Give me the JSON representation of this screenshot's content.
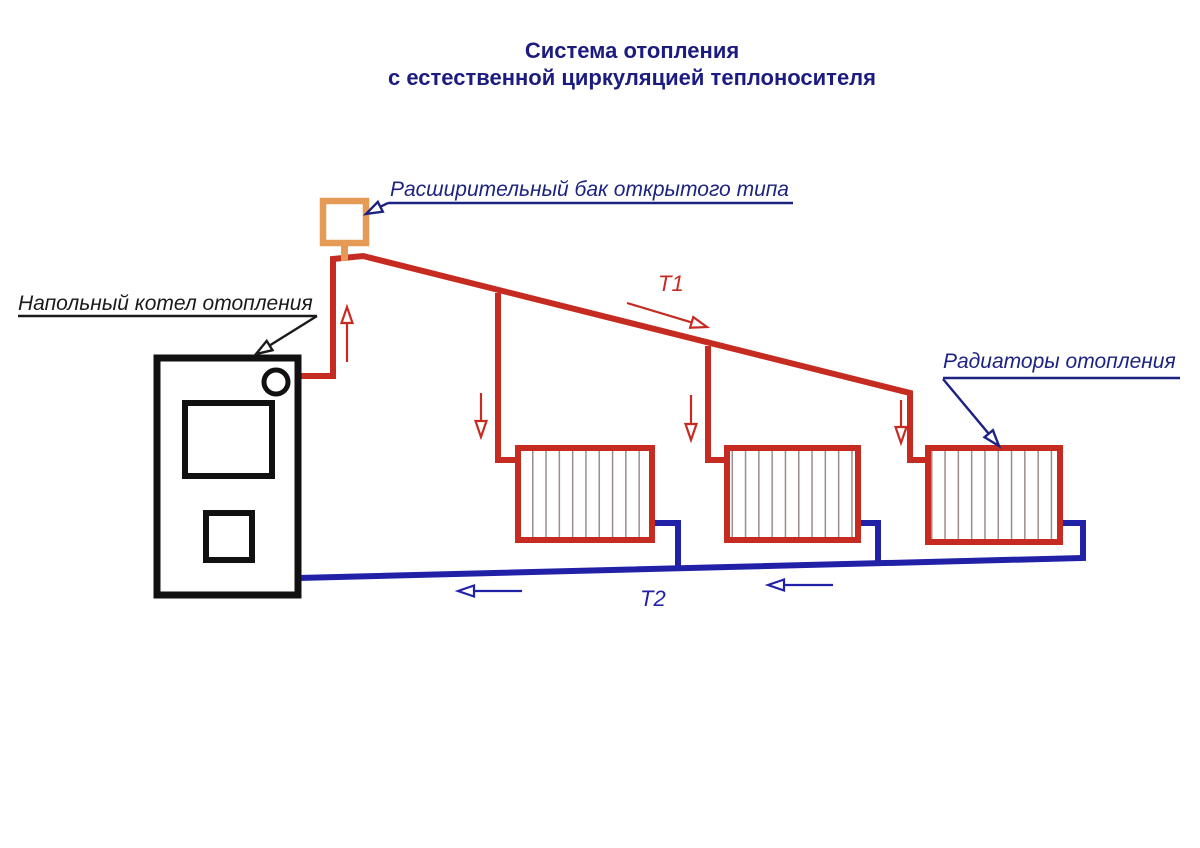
{
  "title": {
    "line1": "Система отопления",
    "line2": "с естественной циркуляцией теплоносителя"
  },
  "callouts": {
    "expansion_tank": "Расширительный бак открытого типа",
    "boiler": "Напольный котел отопления",
    "radiators": "Радиаторы отопления"
  },
  "flow_labels": {
    "supply": "T1",
    "return": "T2"
  },
  "components": {
    "boiler": "напольный котел отопления",
    "expansion_tank": "расширительный бак открытого типа",
    "radiator_count": 3,
    "supply_line": "T1 — подающая линия (горячий теплоноситель)",
    "return_line": "T2 — обратная линия (остывший теплоноситель)"
  },
  "colors": {
    "supply_pipe": "#c62b22",
    "return_pipe": "#2121a8",
    "expansion_tank": "#e59a55",
    "boiler_outline": "#111111",
    "callout_navy": "#1c2380",
    "callout_black": "#1a1a1a",
    "title_text": "#1b1b80",
    "radiator_fin": "#9c8c8c",
    "background": "#ffffff"
  }
}
